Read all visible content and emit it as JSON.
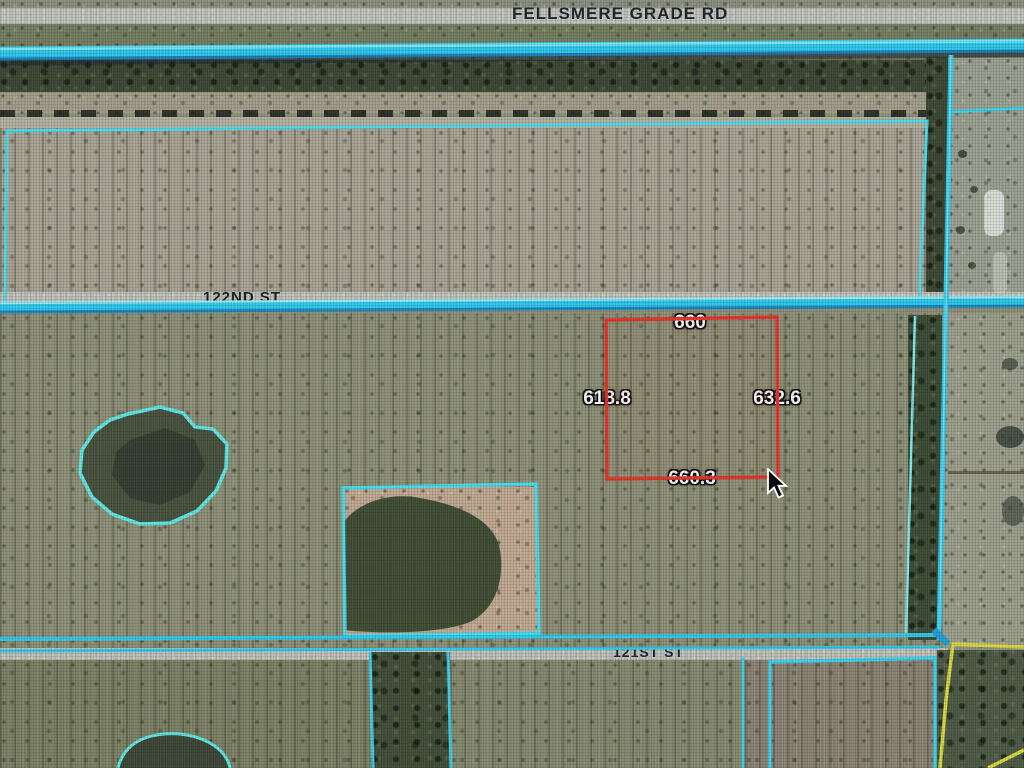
{
  "view": {
    "type": "aerial-parcel-map"
  },
  "roads": {
    "fellsmere": "FELLSMERE GRADE RD",
    "st122": "122ND ST",
    "st121": "121ST ST"
  },
  "selected_parcel": {
    "dim_top": "660",
    "dim_left": "618.8",
    "dim_right": "632.6",
    "dim_bottom": "660.3",
    "outline_color": "#e3342a"
  },
  "colors": {
    "parcel_line_cyan": "#3ad1ec",
    "road_casing_cyan": "#2cc7ea",
    "light_parcel_line": "#7fe9ee",
    "alt_boundary_yellow": "#d8d93f",
    "dimension_text": "#ffffff",
    "road_label_text": "#1d2428"
  },
  "cursor": {
    "icon": "cursor-arrow-icon"
  }
}
